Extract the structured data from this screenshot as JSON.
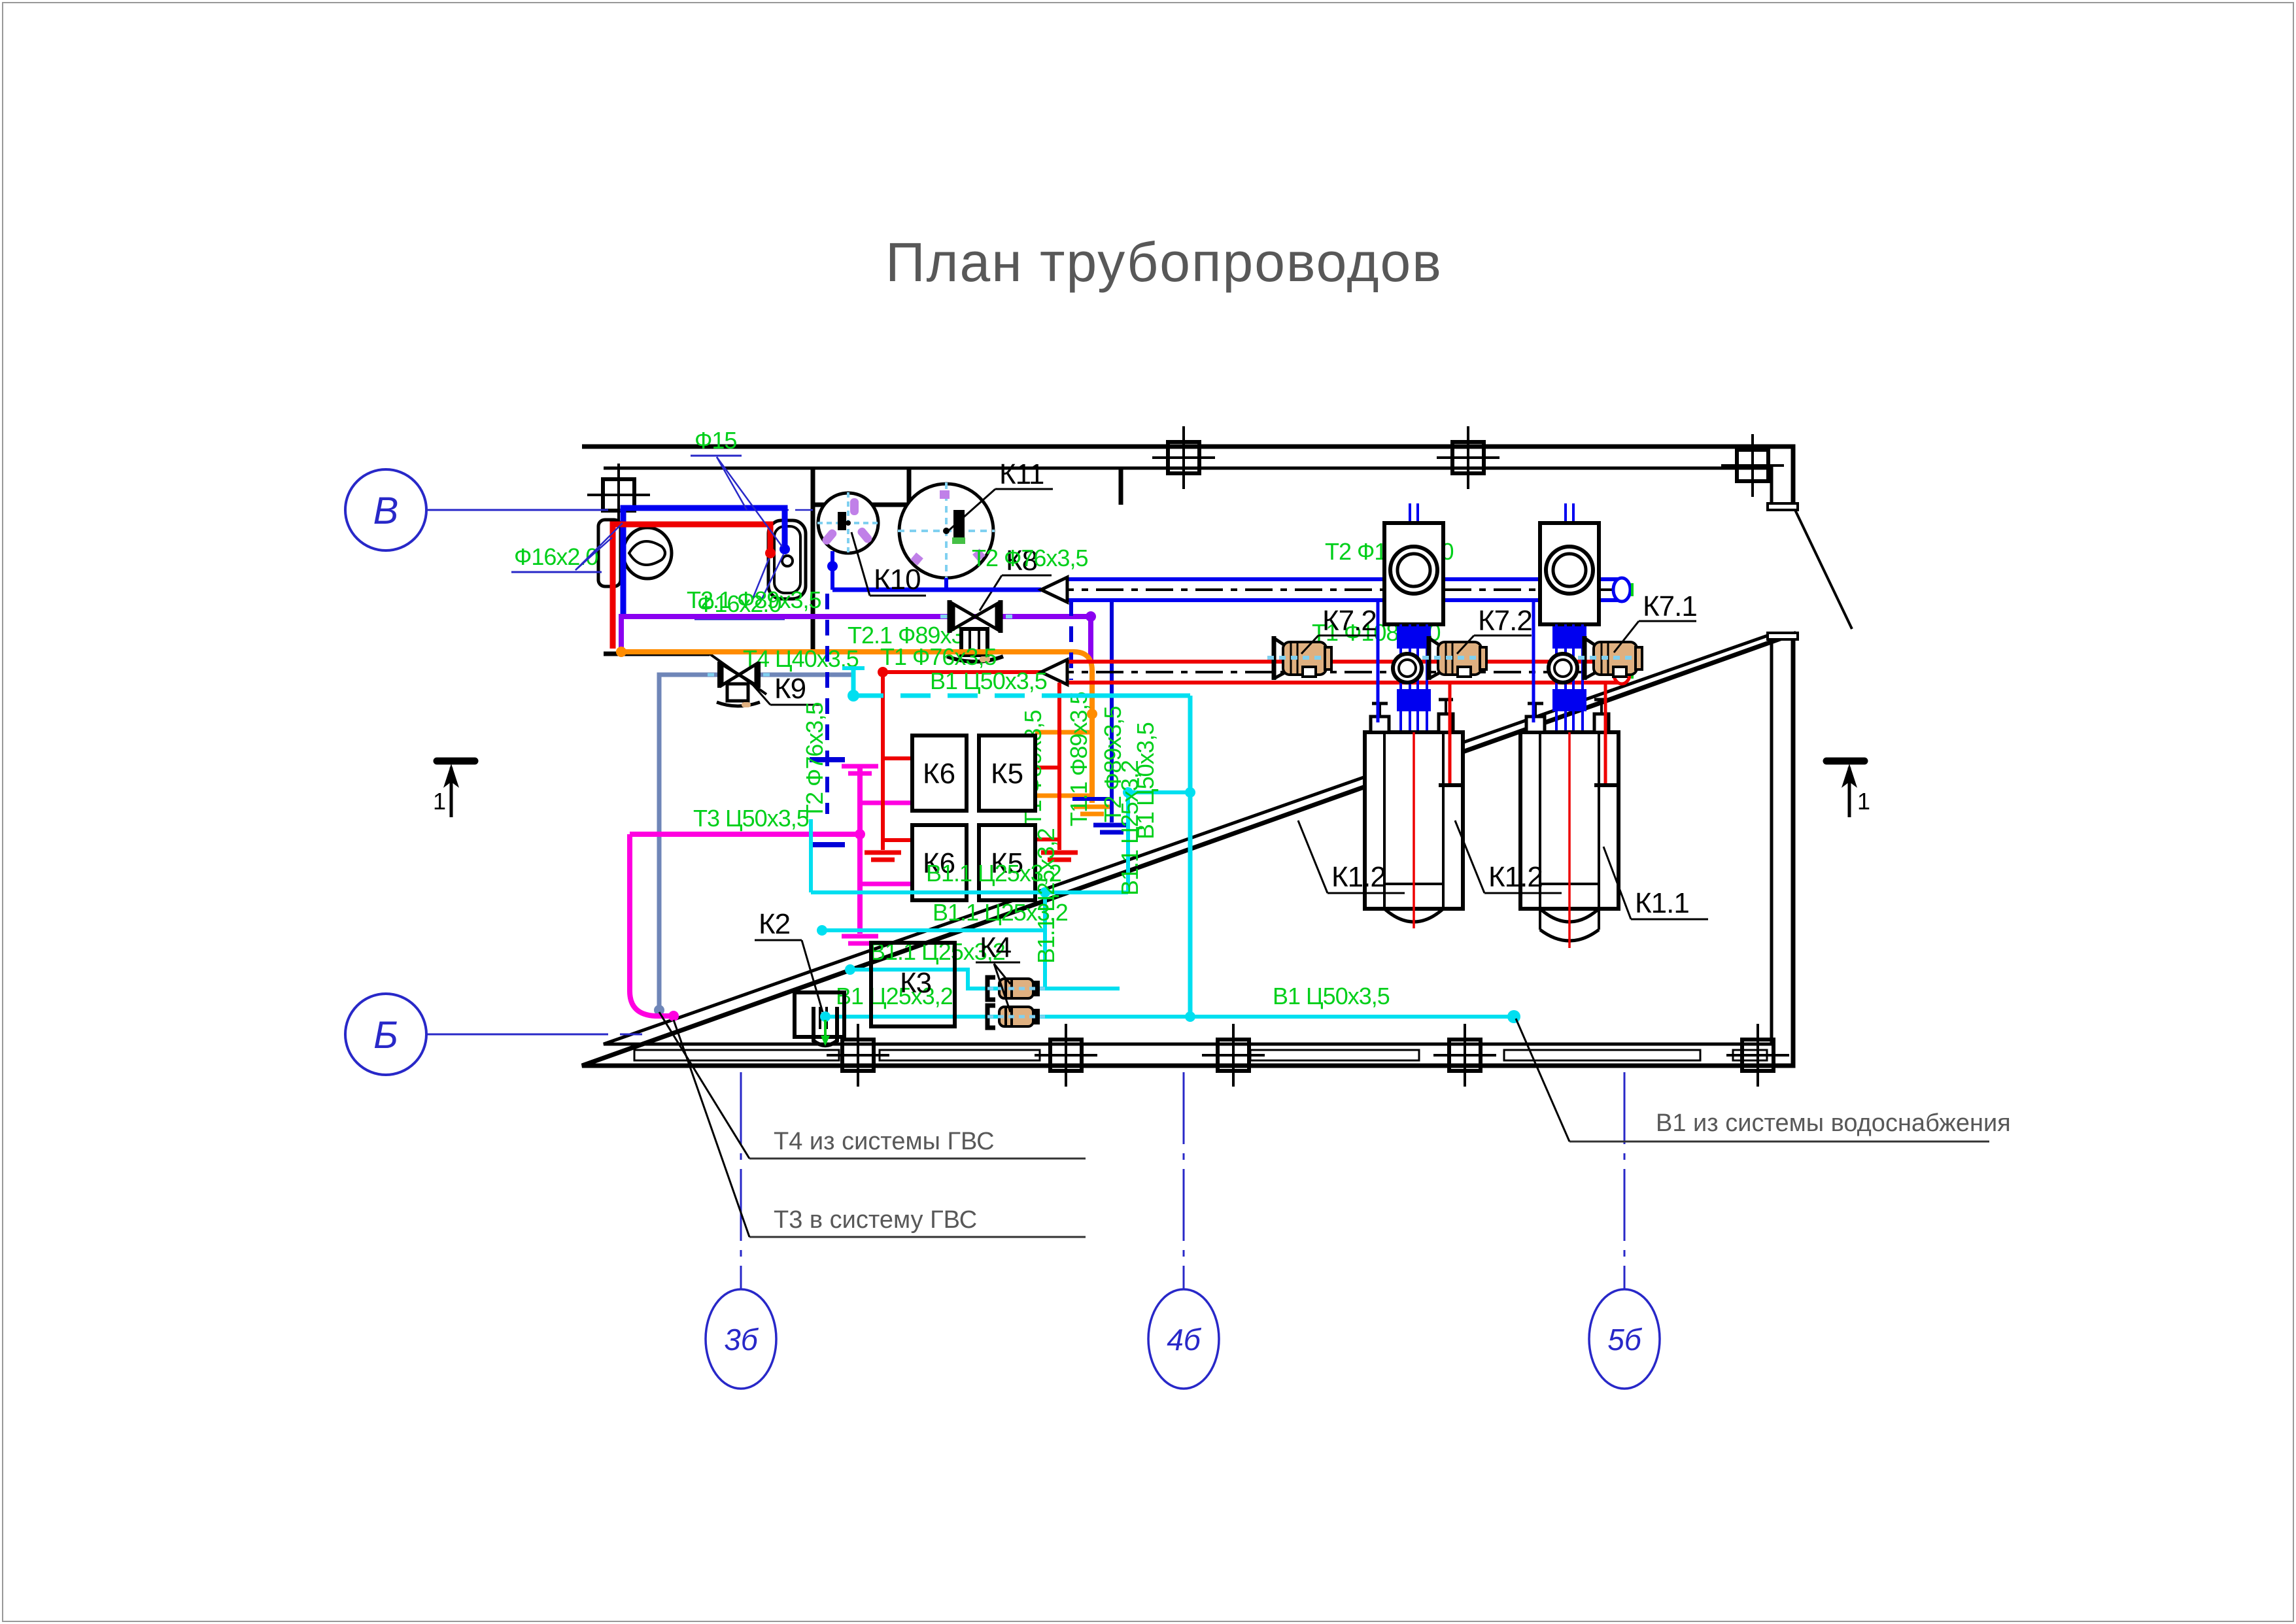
{
  "title": "План трубопроводов",
  "axes": {
    "row_top": "В",
    "row_bottom": "Б",
    "col_1": "3б",
    "col_2": "4б",
    "col_3": "5б"
  },
  "section_marks": {
    "left": "1",
    "right": "1"
  },
  "callouts": {
    "t4": "Т4 из системы ГВС",
    "t3": "Т3 в систему ГВС",
    "b1": "В1 из системы водоснабжения"
  },
  "pipe_labels": {
    "f15": "Ф15",
    "f16_left": "Ф16х2.0",
    "f16_wc": "Ф16х2.0",
    "t21_a": "Т2.1 Ф89х3,5",
    "t21_b": "Т2.1 Ф89х3,5",
    "t1_76": "Т1 Ф76х3,5",
    "t4_40": "Т4 Ц40х3,5",
    "b1_50_a": "В1 Ц50х3,5",
    "t3_50": "Т3 Ц50х3,5",
    "t2_76_v": "Т2 Ф76х3,5",
    "t2_76_h": "Т2 Ф76х3,5",
    "t1_89_v": "Т1 Ф89х3,5",
    "t11_89_v": "Т1.1 Ф89х3,5",
    "t2_89_v": "Т2 Ф89х3,5",
    "b1_50_v": "В1 Ц50х3,5",
    "b11_25_v1": "В1.1 Ц25х3,2",
    "b11_25_v2": "В1.1 Ц25х3,2",
    "t2_108": "Т2 Ф108х4,0",
    "t1_108": "Т1 Ф108х4,0",
    "b11_25_h1": "В1.1 Ц25х3,2",
    "b11_25_h2": "В1.1 Ц25х3,2",
    "b11_25_h3": "В1.1 Ц25х3,2",
    "b1_25_h": "В1 Ц25х3,2",
    "b1_50_b": "В1 Ц50х3,5"
  },
  "equipment": {
    "k1_1": "К1.1",
    "k1_2a": "К1.2",
    "k1_2b": "К1.2",
    "k2": "К2",
    "k3": "К3",
    "k4": "К4",
    "k5": "К5",
    "k6": "К6",
    "k7_1": "К7.1",
    "k7_2a": "К7.2",
    "k7_2b": "К7.2",
    "k8": "К8",
    "k9": "К9",
    "k10": "К10",
    "k11": "К11"
  },
  "colors": {
    "green_label": "#00cf1a",
    "pipe_blue": "#0000f0",
    "pipe_red": "#ee0000",
    "pipe_cyan": "#00dff0",
    "pipe_magenta": "#ff00e0",
    "pipe_orange": "#ff8c00",
    "pipe_purple": "#8a00f0",
    "pipe_slate": "#6f86b8",
    "axis_blue": "#2828c8",
    "light_blue": "#80d0f0",
    "pump_tan": "#dfb080",
    "text_gray": "#585858"
  }
}
